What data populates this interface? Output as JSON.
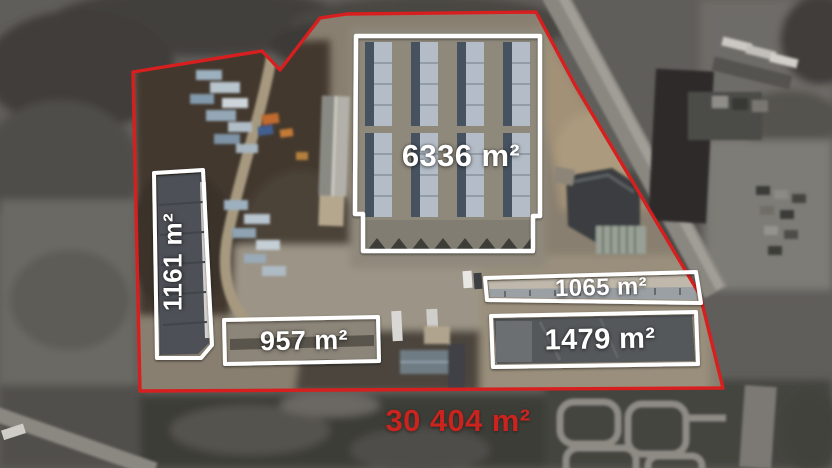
{
  "scene": {
    "kind": "annotated aerial property view",
    "boundary_color": "#d81f1f",
    "building_outline_color": "#ffffff",
    "label_text_color": "#ffffff",
    "total_text_color": "#c9241d"
  },
  "buildings": [
    {
      "id": "warehouse-main",
      "area_label": "6336 m²"
    },
    {
      "id": "hall-west",
      "area_label": "1161 m²"
    },
    {
      "id": "hall-southwest",
      "area_label": "957 m²"
    },
    {
      "id": "hall-east-upper",
      "area_label": "1065 m²"
    },
    {
      "id": "hall-east-lower",
      "area_label": "1479 m²"
    }
  ],
  "total_area_label": "30 404 m²"
}
